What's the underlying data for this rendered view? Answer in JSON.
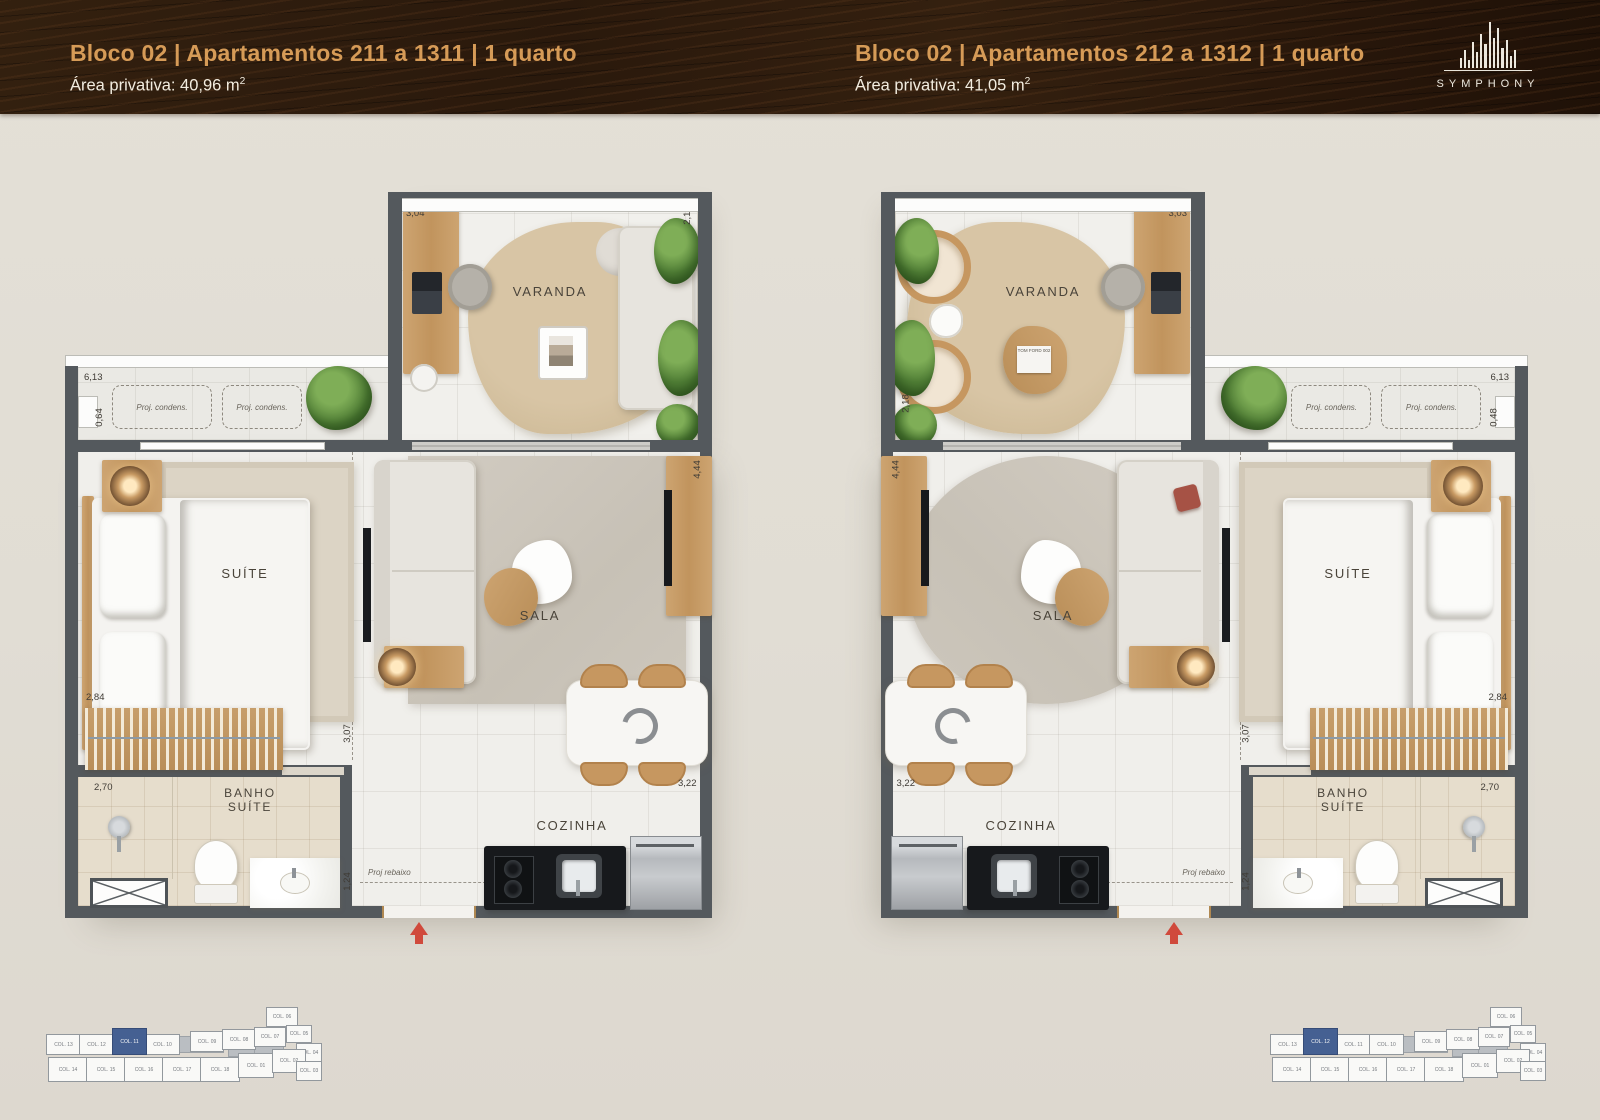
{
  "header": {
    "left": {
      "title": "Bloco 02 | Apartamentos 211 a 1311 | 1 quarto",
      "area_text": "Área privativa: 40,96 m",
      "area_sup": "2"
    },
    "right": {
      "title": "Bloco 02 | Apartamentos 212 a 1312 | 1 quarto",
      "area_text": "Área privativa: 41,05 m",
      "area_sup": "2"
    },
    "logo_text": "SYMPHONY"
  },
  "plans": [
    {
      "rooms": {
        "varanda": "VARANDA",
        "suite": "SUÍTE",
        "sala": "SALA",
        "banho_line1": "BANHO",
        "banho_line2": "SUÍTE",
        "cozinha": "COZINHA"
      },
      "dims": {
        "varanda_width": "3,04",
        "varanda_depth": "2,18",
        "facade_width": "6,13",
        "ledge_depth": "0,64",
        "sala_depth": "4,44",
        "suite_width": "2,84",
        "hall_depth": "3,07",
        "banho_width": "2,70",
        "banho_depth": "1,24",
        "cozinha_width": "3,22"
      },
      "notes": {
        "condens_1": "Proj. condens.",
        "condens_2": "Proj. condens.",
        "rebaixo": "Proj rebaixo"
      },
      "decor_book": ""
    },
    {
      "rooms": {
        "varanda": "VARANDA",
        "suite": "SUÍTE",
        "sala": "SALA",
        "banho_line1": "BANHO",
        "banho_line2": "SUÍTE",
        "cozinha": "COZINHA"
      },
      "dims": {
        "varanda_width": "3,03",
        "varanda_depth": "2,18",
        "facade_width": "6,13",
        "ledge_depth": "0,48",
        "sala_depth": "4,44",
        "suite_width": "2,84",
        "hall_depth": "3,07",
        "banho_width": "2,70",
        "banho_depth": "1,24",
        "cozinha_width": "3,22"
      },
      "notes": {
        "condens_1": "Proj. condens.",
        "condens_2": "Proj. condens.",
        "rebaixo": "Proj rebaixo"
      },
      "decor_book": "TOM FORD 002"
    }
  ],
  "keyplans": [
    {
      "side": "left",
      "highlight": "COL. 11",
      "units_top": [
        "COL. 13",
        "COL. 12",
        "COL. 11",
        "COL. 10",
        "COL. 09",
        "COL. 08",
        "COL. 07",
        "COL. 06",
        "COL. 05",
        "COL. 04"
      ],
      "units_bottom": [
        "COL. 14",
        "COL. 15",
        "COL. 16",
        "COL. 17",
        "COL. 18",
        "COL. 01",
        "COL. 02",
        "COL. 03"
      ]
    },
    {
      "side": "right",
      "highlight": "COL. 12",
      "units_top": [
        "COL. 13",
        "COL. 12",
        "COL. 11",
        "COL. 10",
        "COL. 09",
        "COL. 08",
        "COL. 07",
        "COL. 06",
        "COL. 05",
        "COL. 04"
      ],
      "units_bottom": [
        "COL. 14",
        "COL. 15",
        "COL. 16",
        "COL. 17",
        "COL. 18",
        "COL. 01",
        "COL. 02",
        "COL. 03"
      ]
    }
  ],
  "colors": {
    "header_title": "#d69b57",
    "header_subtitle": "#f2ecdf",
    "wall": "#54595d",
    "keyplan_highlight": "#3d5a8f",
    "entry_arrow": "#d04a3c"
  }
}
